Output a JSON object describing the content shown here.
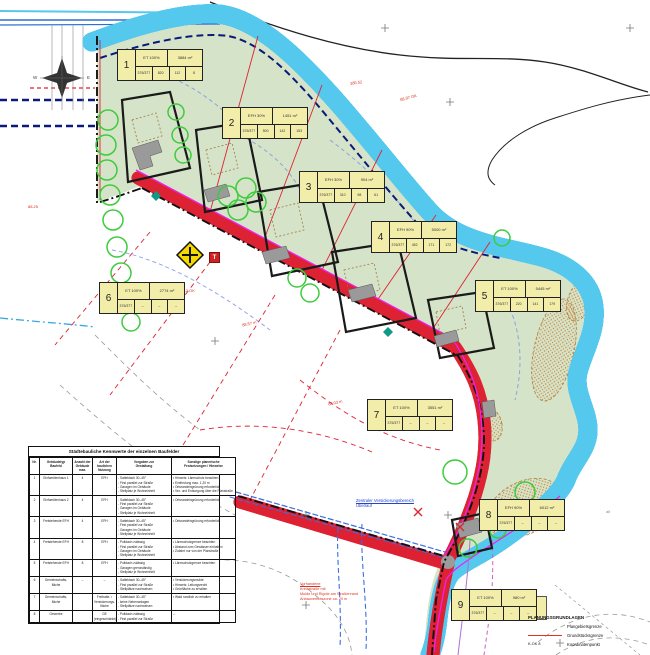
{
  "plan": {
    "lots": [
      {
        "num": "1",
        "type": "ET 100%",
        "area": "3884 m²",
        "cells": [
          "376/377",
          "820",
          "112",
          "8"
        ]
      },
      {
        "num": "2",
        "type": "EFH 30%",
        "area": "1451 m²",
        "cells": [
          "376/377",
          "500",
          "142",
          "153"
        ]
      },
      {
        "num": "3",
        "type": "EFH 30%",
        "area": "904 m²",
        "cells": [
          "376/377",
          "310",
          "98",
          "61"
        ]
      },
      {
        "num": "4",
        "type": "EFH 90%",
        "area": "5000 m²",
        "cells": [
          "376/377",
          "452",
          "171",
          "172"
        ]
      },
      {
        "num": "5",
        "type": "ET 100%",
        "area": "5445 m²",
        "cells": [
          "376/377",
          "220",
          "141",
          "179"
        ]
      },
      {
        "num": "6",
        "type": "ET 100%",
        "area": "2774 m²",
        "cells": [
          "376/377",
          "–",
          "–",
          "–"
        ]
      },
      {
        "num": "7",
        "type": "ET 100%",
        "area": "3551 m²",
        "cells": [
          "376/377",
          "–",
          "–",
          "–"
        ]
      },
      {
        "num": "8",
        "type": "EFH 90%",
        "area": "6012 m²",
        "cells": [
          "376/377",
          "–",
          "–",
          "–"
        ]
      },
      {
        "num": "9",
        "type": "ET 100%",
        "area": "980 m²",
        "cells": [
          "376/377",
          "–",
          "–",
          "–"
        ]
      }
    ]
  },
  "table": {
    "title": "Städtebauliche Kennwerte der einzelnen Baufelder",
    "headers": [
      "Nr.",
      "Gebäudetyp\nBaufeld",
      "Anzahl der\nGebäude\nmax.",
      "Art der\nbaulichen\nNutzung",
      "Vorgaben zur\nGestaltung",
      "Sonstige planerische\nFestsetzungen / Hinweise"
    ],
    "rows": [
      [
        "1",
        "Einfamilienhaus 1",
        "4",
        "EFH",
        "- Satteldach 30–45°\n- First parallel zur Straße\n- Garagen im Gebäude\n- Stellplatz je Wohneinheit",
        "• Hinweis: Lärmschutz beachten\n• Einfriedung max. 1,20 m\n• Ortsrandeingrünung erforderlich\n• Ver- und Entsorgung über die Planstraße"
      ],
      [
        "2",
        "Einfamilienhaus 2",
        "4",
        "EFH",
        "- Satteldach 30–45°\n- First parallel zur Straße\n- Garagen im Gebäude\n- Stellplatz je Wohneinheit",
        "• Ortsrandeingrünung erforderlich"
      ],
      [
        "3",
        "Freistehende EFH",
        "4",
        "EFH",
        "- Satteldach 30–45°\n- First parallel zur Straße\n- Garagen im Gebäude\n- Stellplatz je Wohneinheit",
        "• Ortsrandeingrünung erforderlich"
      ],
      [
        "4",
        "Freistehende EFH",
        "8",
        "EFH",
        "- Pultdach zulässig\n- First parallel zur Straße\n- Garagen im Gebäude\n- Stellplatz je Wohneinheit",
        "• Lärmschutzgrenze beachten\n• Abstand zum Gewässer einhalten\n• Zufahrt nur von der Planstraße"
      ],
      [
        "5",
        "Freistehende EFH",
        "8",
        "EFH",
        "- Pultdach zulässig\n- Garagen grenzständig\n- Stellplatz je Wohneinheit",
        "• Lärmschutzgrenze beachten"
      ],
      [
        "6",
        "Gemeinschafts-\nfläche",
        "–",
        "–",
        "- Satteldach 30–45°\n- First parallel zur Straße\n- Stellplätze nachweisen",
        "• Versickerungsmulde\n• Hinweis: Leitungsrecht\n• Grünfläche zu erhalten"
      ],
      [
        "7",
        "Gemeinschafts-\nfläche",
        "",
        "Freihalte- /\nVersickerungs-\nfläche",
        "- Satteldach 30–45°\n- keine Nebenanlagen\n- Stellplätze nachweisen",
        "• Wald randlich zu erhalten"
      ],
      [
        "8",
        "Gewerbe",
        "",
        "GE\n(eingeschränkt)",
        "- Pultdach zulässig\n- First parallel zur Straße",
        "–"
      ]
    ]
  },
  "legend": {
    "title": "PLANUNGSGRUNDLAGEN",
    "items": [
      {
        "label": "Plangebietsgrenze"
      },
      {
        "label": "Grundstücksgrenze"
      },
      {
        "sample": "K-OK  8",
        "label": "Koordinatenpunkt"
      }
    ]
  },
  "annotations": {
    "elev1": "385.52",
    "elev2": "88.97 OK",
    "elev3": "88.12 OK",
    "elev4": "88.25",
    "elev5": "88.57 m",
    "elev6": "88.03 m",
    "alt_note": "alt",
    "infiltration_line1": "Zentraler Versickerungsbereich",
    "infiltration_line2": "Überlauf",
    "road_note_line1": "Vorhandene",
    "road_note_line2": "Kreisstraße mit",
    "road_note_line3": "Mulde und Rigole am Straßenrand",
    "road_note_line4": "Anbauverbotszone ca. 20 m"
  },
  "signs": {
    "t": "T"
  },
  "compass": {
    "west": "W",
    "east": "E"
  },
  "colors": {
    "site_green": "#d5e4c8",
    "road_gray": "#9b9b9b",
    "water_cyan": "#55c8ee",
    "water_blue": "#2b6fd4",
    "water_navy": "#0a1a7a",
    "boundary_black": "#111111",
    "parcel_red": "#dd2233",
    "utility_magenta": "#ee22ee",
    "label_yellow": "#f3edaa",
    "tree_green": "#3ecb3e",
    "stipple_orange": "#c9762f"
  }
}
